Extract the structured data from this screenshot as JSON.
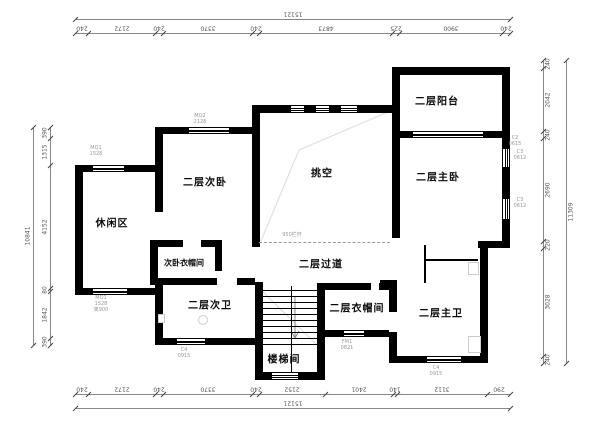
{
  "drawing": {
    "type": "second-floor plan",
    "rooms": [
      {
        "id": "balcony",
        "label": "二层阳台",
        "x": 437,
        "y": 100
      },
      {
        "id": "master-bedroom",
        "label": "二层主卧",
        "x": 438,
        "y": 176
      },
      {
        "id": "void",
        "label": "挑空",
        "x": 322,
        "y": 172
      },
      {
        "id": "secondary-bedroom",
        "label": "二层次卧",
        "x": 205,
        "y": 181
      },
      {
        "id": "leisure-area",
        "label": "休闲区",
        "x": 112,
        "y": 222
      },
      {
        "id": "secondary-closet",
        "label": "次卧衣帽间",
        "x": 184,
        "y": 263,
        "small": true
      },
      {
        "id": "corridor",
        "label": "二层过道",
        "x": 321,
        "y": 263
      },
      {
        "id": "secondary-bath",
        "label": "二层次卫",
        "x": 210,
        "y": 304
      },
      {
        "id": "cloakroom",
        "label": "二层衣帽间",
        "x": 357,
        "y": 307
      },
      {
        "id": "master-bath",
        "label": "二层主卫",
        "x": 441,
        "y": 312
      },
      {
        "id": "stairwell",
        "label": "楼梯间",
        "x": 284,
        "y": 358
      }
    ],
    "railing_note": "950栏杆",
    "window_tags": [
      {
        "x": 96,
        "y": 146,
        "lines": [
          "MQ1",
          "1528"
        ]
      },
      {
        "x": 101,
        "y": 296,
        "lines": [
          "MQ1",
          "1528",
          "离900"
        ]
      },
      {
        "x": 200,
        "y": 114,
        "lines": [
          "MQ2",
          "2128"
        ]
      },
      {
        "x": 515,
        "y": 136,
        "lines": [
          "C2",
          "0615"
        ]
      },
      {
        "x": 520,
        "y": 150,
        "lines": [
          "C3",
          "0612"
        ]
      },
      {
        "x": 520,
        "y": 198,
        "lines": [
          "C3",
          "0612"
        ]
      },
      {
        "x": 184,
        "y": 348,
        "lines": [
          "C4",
          "0915"
        ]
      },
      {
        "x": 436,
        "y": 366,
        "lines": [
          "C4",
          "0915"
        ]
      },
      {
        "x": 347,
        "y": 340,
        "lines": [
          "FM1",
          "0821"
        ]
      }
    ],
    "dimensions": {
      "top": {
        "total": "15121",
        "labels": [
          "240",
          "2172",
          "240",
          "3370",
          "240",
          "4873",
          "225",
          "3900",
          "240"
        ],
        "bounds": [
          75,
          88,
          155,
          163,
          252,
          259,
          392,
          399,
          502,
          510
        ],
        "chain_pos": 33,
        "total_pos": 19
      },
      "bottom": {
        "total": "15121",
        "labels": [
          "240",
          "2172",
          "240",
          "3370",
          "240",
          "2152",
          "2401",
          "140",
          "3112",
          "290"
        ],
        "bounds": [
          75,
          88,
          155,
          163,
          252,
          259,
          325,
          393,
          397,
          487,
          510
        ],
        "chain_pos": 394,
        "total_pos": 408
      },
      "left": {
        "total": "10841",
        "labels": [
          "390",
          "1315",
          "4152",
          "80",
          "1842",
          "390"
        ],
        "bounds": [
          127,
          138,
          165,
          288,
          291,
          338,
          345
        ],
        "chain_pos": 50,
        "total_pos": 33
      },
      "right": {
        "total": "11309",
        "labels": [
          "240",
          "2042",
          "240",
          "2690",
          "220",
          "3028",
          "240"
        ],
        "bounds": [
          60,
          68,
          131,
          138,
          241,
          248,
          356,
          363
        ],
        "chain_pos": 543,
        "total_pos": 566
      }
    },
    "geometry": {
      "walls": [
        [
          392,
          67,
          118,
          8
        ],
        [
          392,
          67,
          8,
          71
        ],
        [
          502,
          67,
          8,
          81
        ],
        [
          502,
          168,
          8,
          30
        ],
        [
          502,
          220,
          8,
          28
        ],
        [
          392,
          131,
          20,
          7
        ],
        [
          484,
          131,
          26,
          7
        ],
        [
          392,
          138,
          8,
          100
        ],
        [
          478,
          241,
          32,
          7
        ],
        [
          480,
          248,
          8,
          115
        ],
        [
          389,
          356,
          37,
          7
        ],
        [
          462,
          356,
          25,
          7
        ],
        [
          380,
          280,
          17,
          6
        ],
        [
          389,
          280,
          8,
          32
        ],
        [
          389,
          332,
          8,
          24
        ],
        [
          317,
          283,
          8,
          97
        ],
        [
          325,
          283,
          46,
          7
        ],
        [
          379,
          283,
          10,
          7
        ],
        [
          325,
          330,
          18,
          7
        ],
        [
          365,
          330,
          24,
          7
        ],
        [
          255,
          282,
          8,
          96
        ],
        [
          255,
          372,
          16,
          8
        ],
        [
          299,
          372,
          26,
          8
        ],
        [
          150,
          278,
          67,
          7
        ],
        [
          237,
          278,
          18,
          7
        ],
        [
          155,
          338,
          21,
          7
        ],
        [
          206,
          338,
          49,
          7
        ],
        [
          155,
          285,
          8,
          60
        ],
        [
          150,
          240,
          33,
          7
        ],
        [
          201,
          240,
          21,
          7
        ],
        [
          215,
          247,
          7,
          24
        ],
        [
          150,
          240,
          8,
          45
        ],
        [
          75,
          165,
          8,
          130
        ],
        [
          75,
          165,
          17,
          7
        ],
        [
          125,
          165,
          30,
          7
        ],
        [
          75,
          288,
          17,
          7
        ],
        [
          128,
          288,
          27,
          7
        ],
        [
          155,
          127,
          8,
          85
        ],
        [
          155,
          127,
          33,
          7
        ],
        [
          230,
          127,
          30,
          7
        ],
        [
          252,
          105,
          8,
          142
        ],
        [
          252,
          105,
          38,
          8
        ],
        [
          305,
          105,
          10,
          8
        ],
        [
          330,
          105,
          10,
          8
        ],
        [
          358,
          105,
          34,
          8
        ]
      ],
      "windows_h": [
        [
          92,
          165,
          33,
          7
        ],
        [
          92,
          288,
          36,
          7
        ],
        [
          188,
          127,
          42,
          7
        ],
        [
          290,
          105,
          15,
          8
        ],
        [
          315,
          105,
          15,
          8
        ],
        [
          340,
          105,
          18,
          8
        ],
        [
          412,
          131,
          72,
          7
        ],
        [
          176,
          338,
          30,
          7
        ],
        [
          271,
          372,
          28,
          8
        ],
        [
          343,
          330,
          22,
          7
        ],
        [
          426,
          356,
          36,
          7
        ]
      ],
      "windows_v": [
        [
          502,
          148,
          8,
          20
        ],
        [
          502,
          198,
          8,
          22
        ]
      ],
      "thin_lines": [
        [
          424,
          245,
          2,
          38
        ],
        [
          426,
          259,
          52,
          2
        ],
        [
          291,
          286,
          1,
          86
        ]
      ],
      "stairs": {
        "x": 263,
        "y": 290,
        "w": 54,
        "h": 55
      },
      "dashed_railing": {
        "x": 259,
        "y": 242,
        "w": 131
      },
      "diagonals": [
        [
          388,
          112,
          299,
          150
        ],
        [
          299,
          150,
          261,
          241
        ],
        [
          261,
          290,
          316,
          344
        ]
      ],
      "stair_arrow": {
        "x": 295,
        "y1": 296,
        "y2": 338
      },
      "fixture_rects": [
        [
          468,
          262,
          11,
          13
        ],
        [
          468,
          336,
          13,
          17
        ],
        [
          158,
          314,
          7,
          9
        ]
      ],
      "fixture_circles": [
        [
          203,
          320,
          4.5
        ]
      ]
    }
  }
}
